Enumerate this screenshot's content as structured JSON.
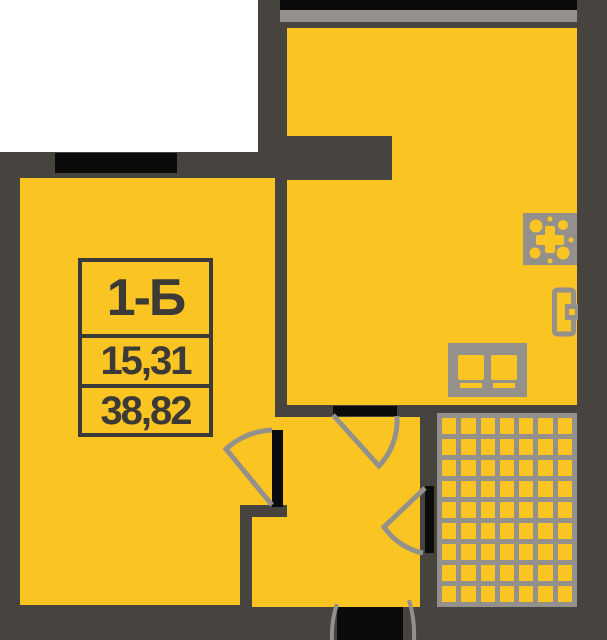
{
  "unit": {
    "code": "1-Б",
    "area_living": "15,31",
    "area_total": "38,82"
  },
  "colors": {
    "floor": "#FAC423",
    "wall": "#474440",
    "opening": "#0B0B0B",
    "fixture": "#94918C",
    "outside": "#FFFFFF",
    "label_text": "#3B3A37"
  },
  "bathroom": {
    "cols": 7,
    "rows": 9
  },
  "icons": [
    {
      "name": "stove-icon"
    },
    {
      "name": "fridge-icon"
    },
    {
      "name": "kitchen-counter-icon"
    }
  ]
}
